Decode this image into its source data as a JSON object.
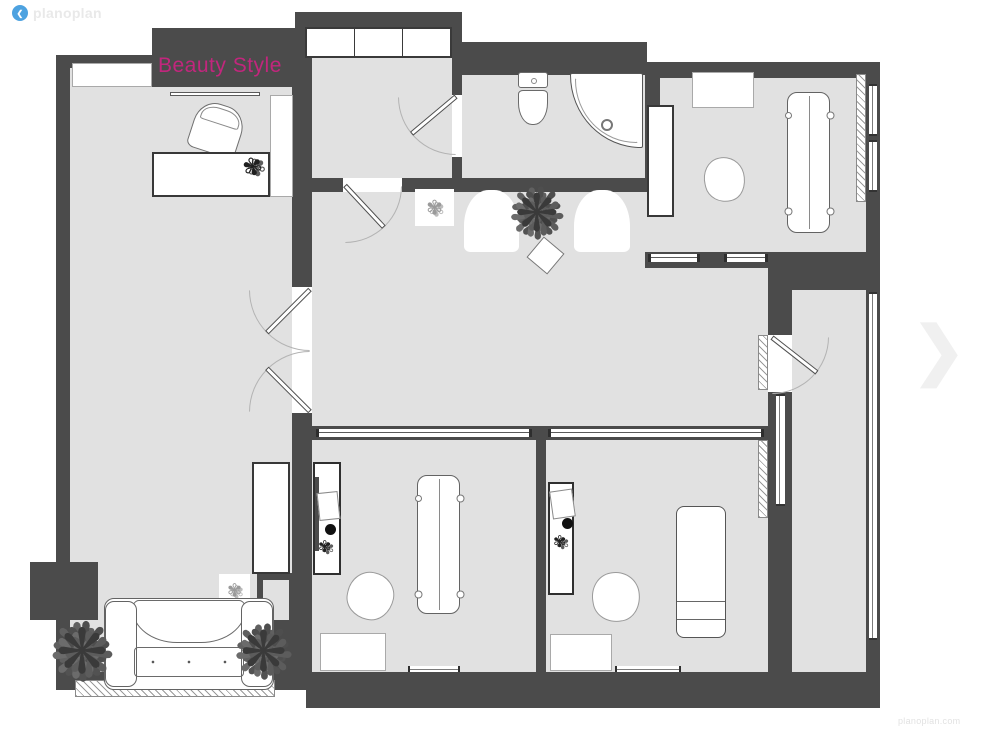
{
  "branding": {
    "logo_text": "planoplan",
    "watermark": "planoplan.com",
    "logo_color": "#4da2e0",
    "logo_text_color": "#e9e9e9"
  },
  "plan": {
    "title": "Beauty Style",
    "title_color": "#c2267d",
    "wall_color": "#4b4b4b",
    "floor_color": "#e1e1e1"
  },
  "icons": {
    "logo_glyph": "❮",
    "chevron_right": "❯",
    "plant_glyph": "❋",
    "scribble_glyph": "✾"
  }
}
